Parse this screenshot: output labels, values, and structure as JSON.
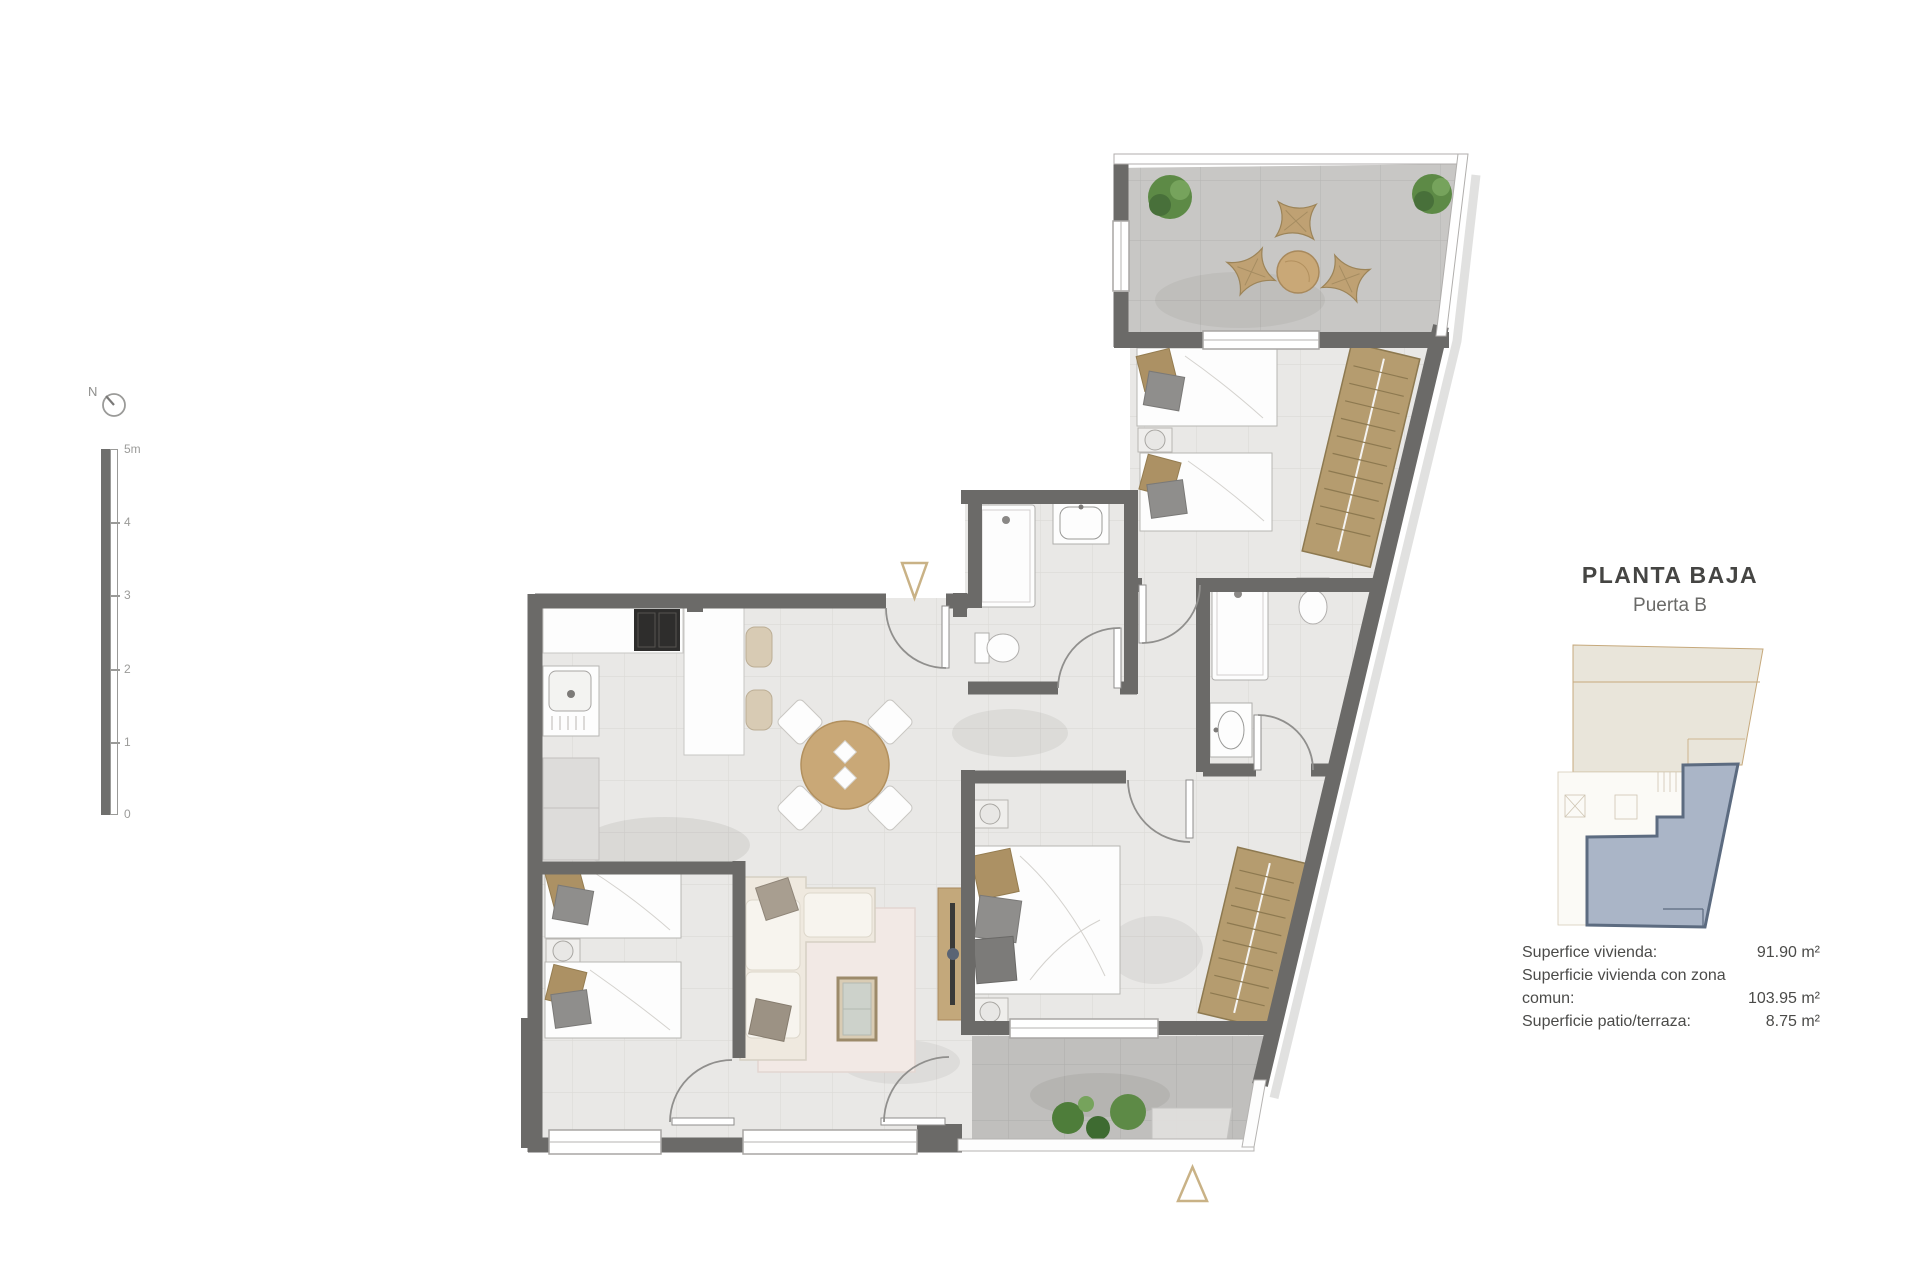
{
  "panel": {
    "title": "PLANTA BAJA",
    "subtitle": "Puerta B",
    "areas": [
      {
        "label": "Superfice vivienda:",
        "value": "91.90 m²"
      },
      {
        "label": "Superficie vivienda con zona comun:",
        "value": "103.95 m²"
      },
      {
        "label": "Superficie patio/terraza:",
        "value": "8.75 m²"
      }
    ]
  },
  "compass": {
    "label": "N"
  },
  "scale": {
    "labels": [
      "5m",
      "4",
      "3",
      "2",
      "1",
      "0"
    ]
  },
  "icons": {
    "compass-icon": "circle-with-needle",
    "entrance-marker-icon": "open-gold-triangle",
    "plant-icon": "green-circle-cluster"
  },
  "colors": {
    "wall": "#6b6a68",
    "floor_light": "#e9e8e6",
    "floor_terrace": "#c8c7c5",
    "wood": "#c9a877",
    "wardrobe": "#b59c6f",
    "gold_marker": "#c9b286",
    "keyplan_highlight": "#aab5c7",
    "keyplan_outline": "#5c6b80",
    "keyplan_beige": "#e9e5da",
    "text_dark": "#454543",
    "text_gray": "#9b9b99"
  }
}
